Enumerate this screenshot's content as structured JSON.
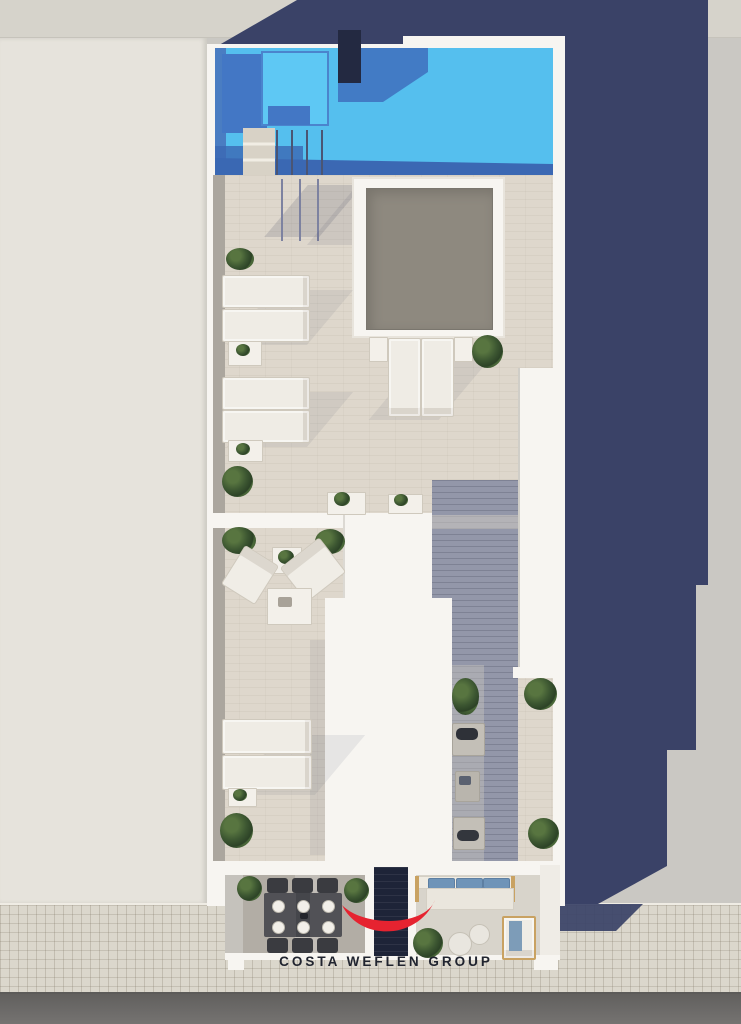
{
  "branding": {
    "logo_text": "COSTA WEFLEN GROUP"
  },
  "colors": {
    "accent_red": "#e62330",
    "pool_water": "#55bfee",
    "pool_bench_light": "#5ec8f4",
    "pool_mid_blue": "#4377c5",
    "pool_shadow_blue": "#3b68b3",
    "shadow_navy": "#3a4267",
    "dark_block": "#232941",
    "dark_glass": "#1e2438",
    "building_white": "#f7f5f1",
    "travertine": "#ded7cc",
    "decking_gray": "#9397a9",
    "skylight_gray": "#8e897f",
    "plant_green": "#3c5631",
    "roof_left": "#e6e3dc",
    "ground_right": "#cac8c3",
    "parapet_strip": "#d6d3cb",
    "sidewalk": "#dbd7cc",
    "road": "#6f6d6b",
    "text_dark": "#20242f"
  }
}
